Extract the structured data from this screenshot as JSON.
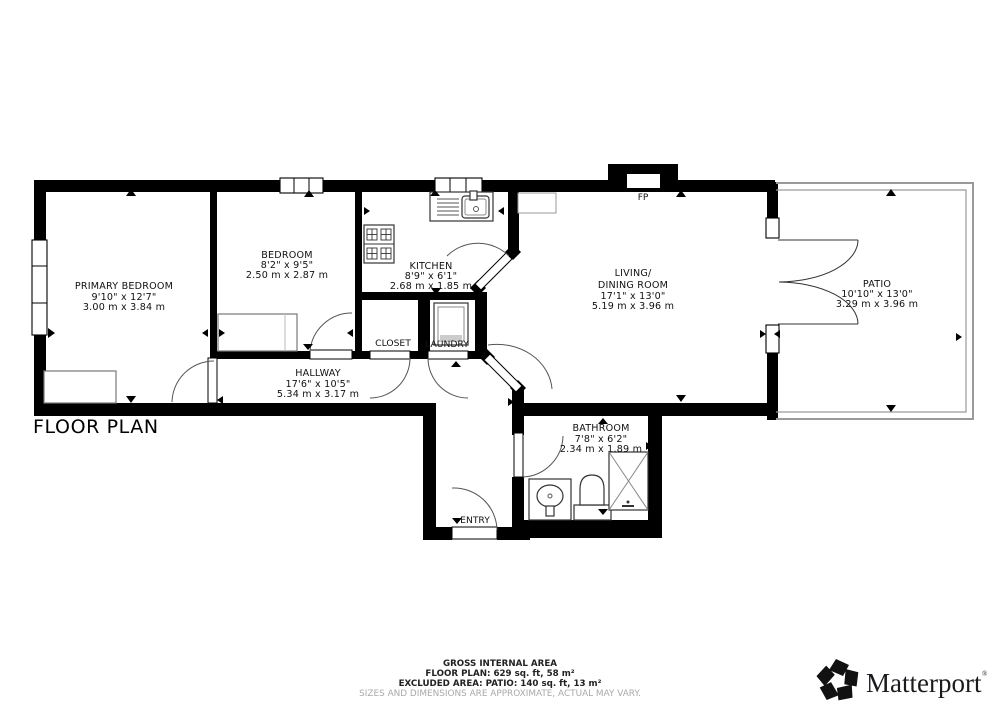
{
  "title": "FLOOR PLAN",
  "rooms": {
    "primary_bedroom": {
      "name": "PRIMARY BEDROOM",
      "imperial": "9'10\" x 12'7\"",
      "metric": "3.00 m x 3.84 m"
    },
    "bedroom": {
      "name": "BEDROOM",
      "imperial": "8'2\" x 9'5\"",
      "metric": "2.50 m x 2.87 m"
    },
    "kitchen": {
      "name": "KITCHEN",
      "imperial": "8'9\" x 6'1\"",
      "metric": "2.68 m x 1.85 m"
    },
    "living_dining": {
      "name1": "LIVING/",
      "name2": "DINING ROOM",
      "imperial": "17'1\" x 13'0\"",
      "metric": "5.19 m x 3.96 m"
    },
    "hallway": {
      "name": "HALLWAY",
      "imperial": "17'6\" x 10'5\"",
      "metric": "5.34 m x 3.17 m"
    },
    "bathroom": {
      "name": "BATHROOM",
      "imperial": "7'8\" x 6'2\"",
      "metric": "2.34 m x 1.89 m"
    },
    "patio": {
      "name": "PATIO",
      "imperial": "10'10\" x 13'0\"",
      "metric": "3.29 m x 3.96 m"
    },
    "closet": {
      "name": "CLOSET"
    },
    "laundry": {
      "name": "LAUNDRY"
    },
    "entry": {
      "name": "ENTRY"
    },
    "fireplace": {
      "abbr": "FP"
    }
  },
  "footer": {
    "line1": "GROSS INTERNAL AREA",
    "line2": "FLOOR PLAN: 629 sq. ft, 58 m²",
    "line3": "EXCLUDED AREA: PATIO: 140 sq. ft, 13 m²",
    "disclaimer": "SIZES AND DIMENSIONS ARE APPROXIMATE, ACTUAL MAY VARY."
  },
  "brand": {
    "name": "Matterport",
    "registered": "®"
  },
  "colors": {
    "wall": "#000000",
    "patio_border": "#9a9a9a",
    "door_arc": "#555555",
    "disclaimer_text": "#a8a8a8",
    "background": "#ffffff"
  }
}
